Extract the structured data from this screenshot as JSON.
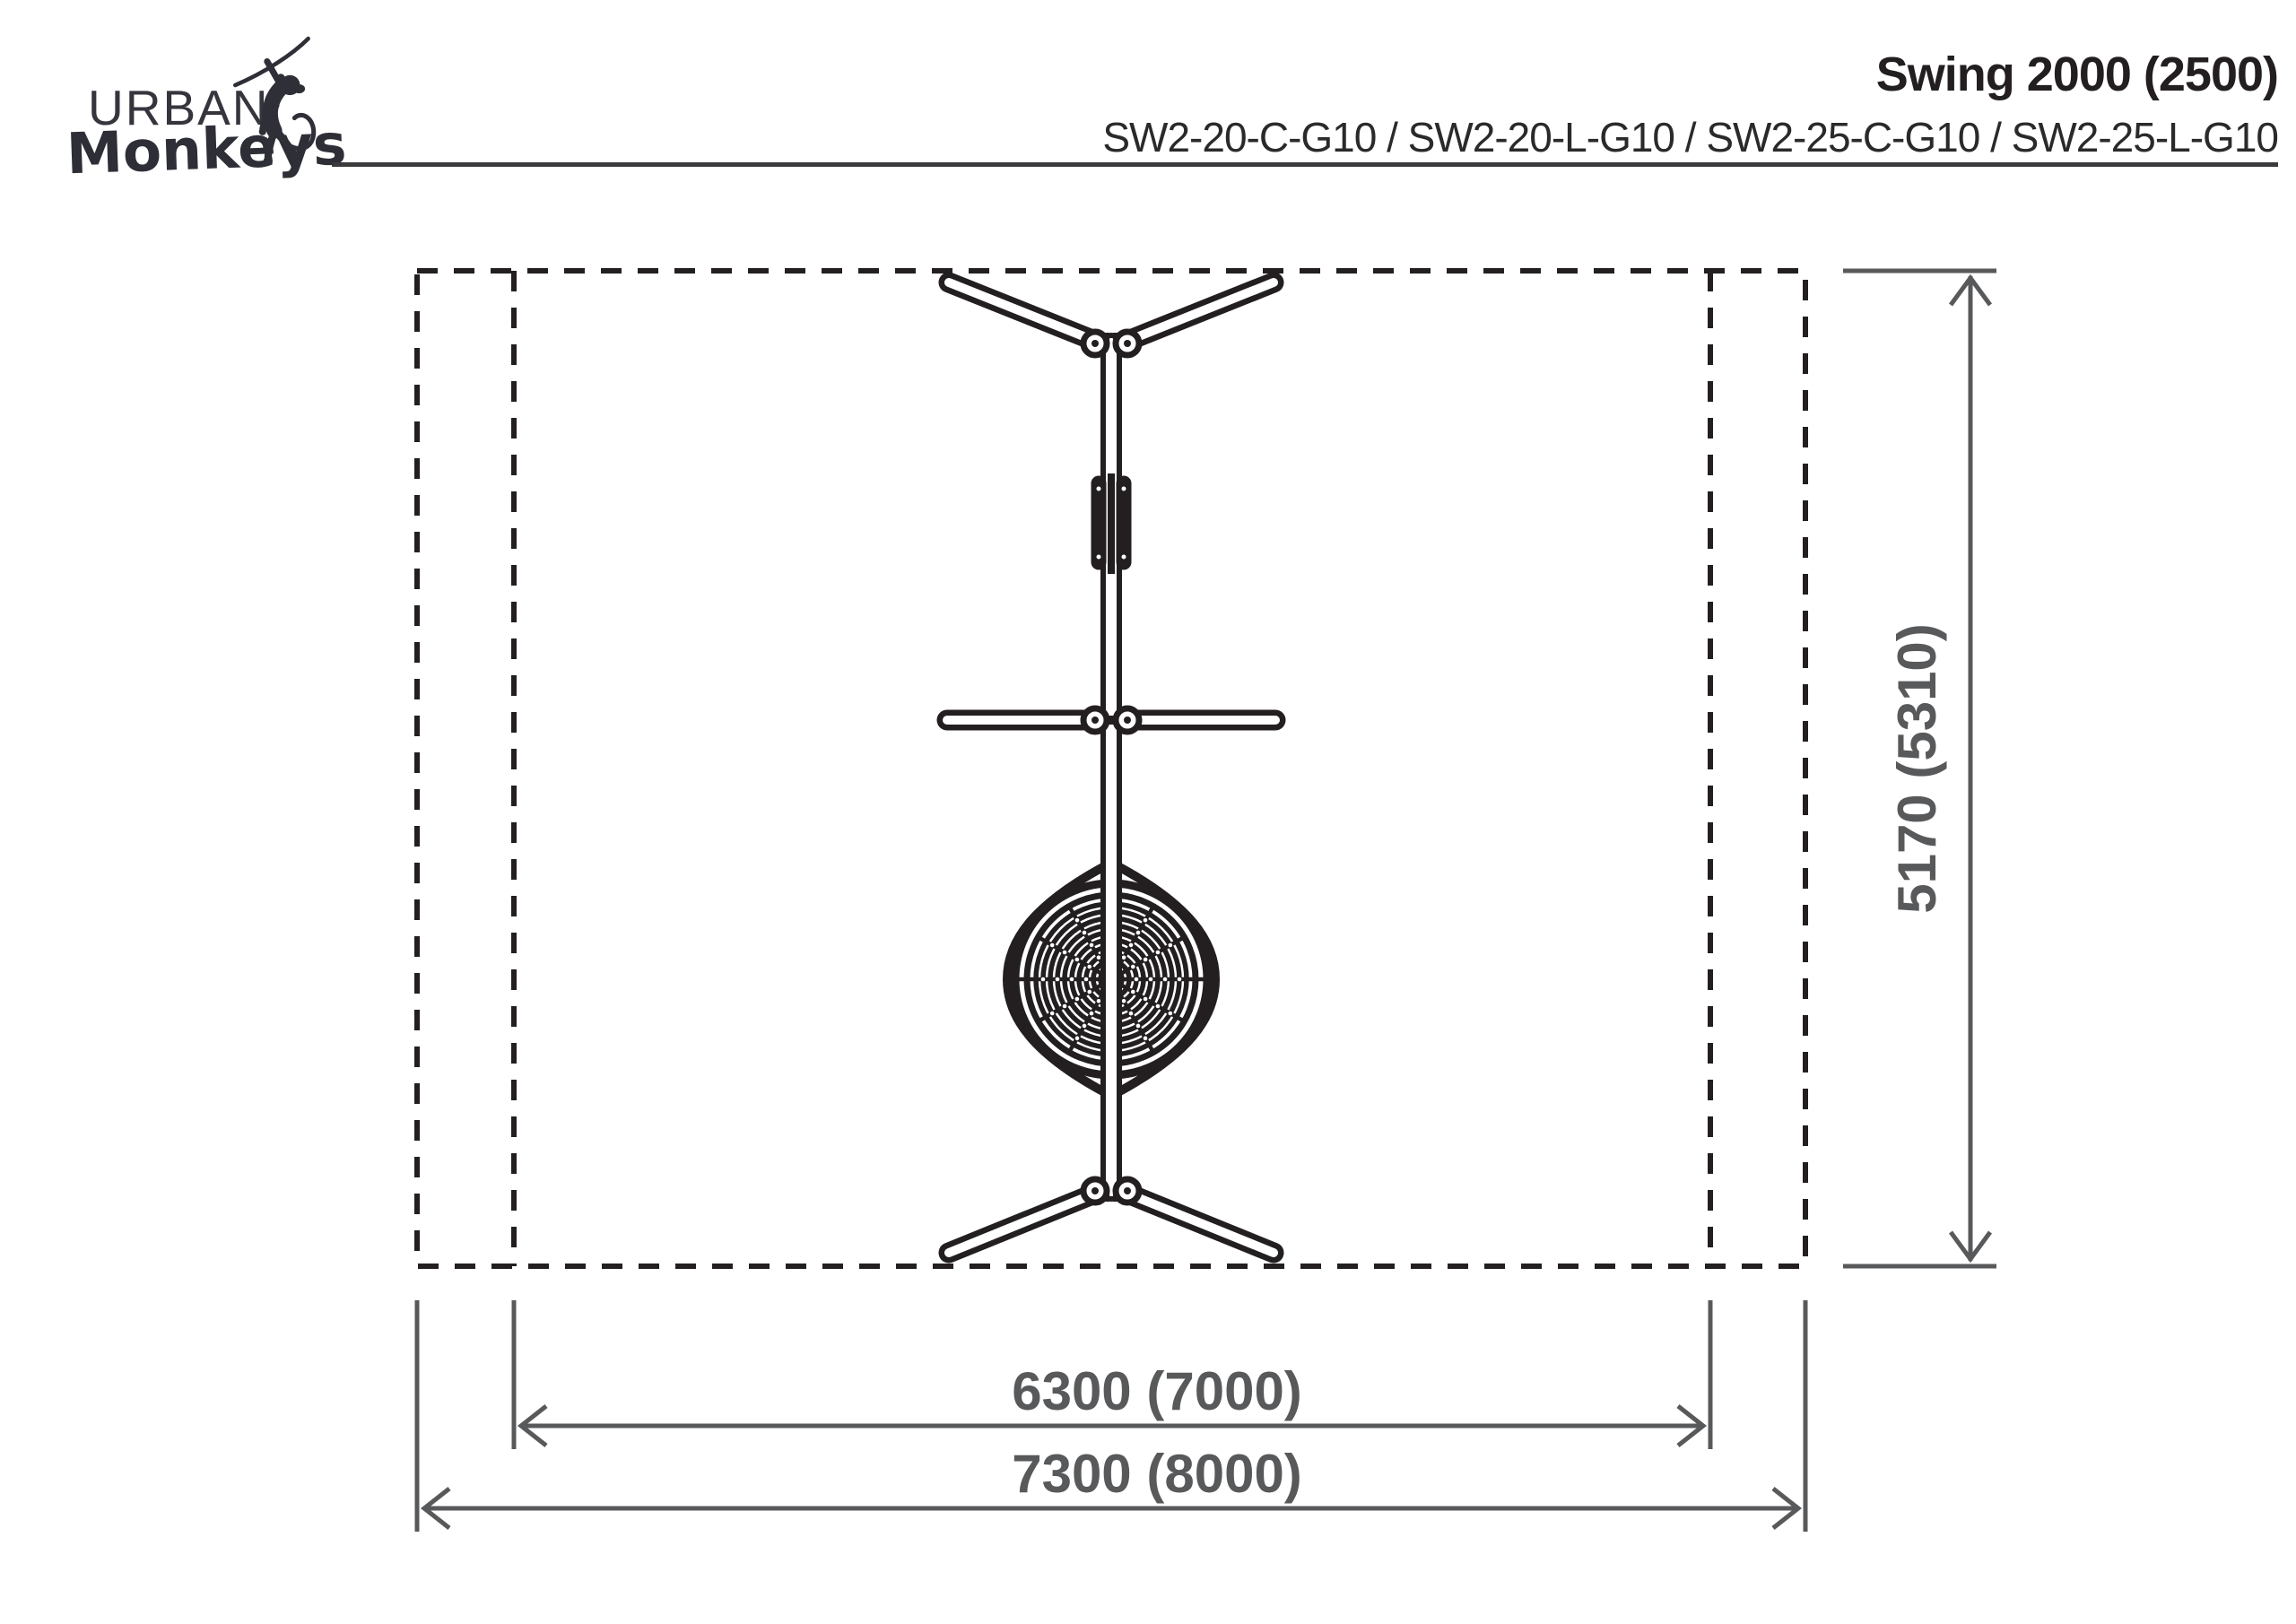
{
  "brand": {
    "name_top": "URBAN",
    "name_bottom": "Monkeys",
    "icon": "monkey-on-rope-icon"
  },
  "header": {
    "title": "Swing 2000 (2500)",
    "product_codes": "SW2-20-C-G10 / SW2-20-L-G10 / SW2-25-C-G10 / SW2-25-L-G10"
  },
  "dimensions": {
    "inner_width": "6300 (7000)",
    "outer_width": "7300 (8000)",
    "depth": "5170 (5310)"
  },
  "colors": {
    "ink": "#231f20",
    "dimension_gray": "#58595b",
    "logo": "#2f2f38"
  }
}
